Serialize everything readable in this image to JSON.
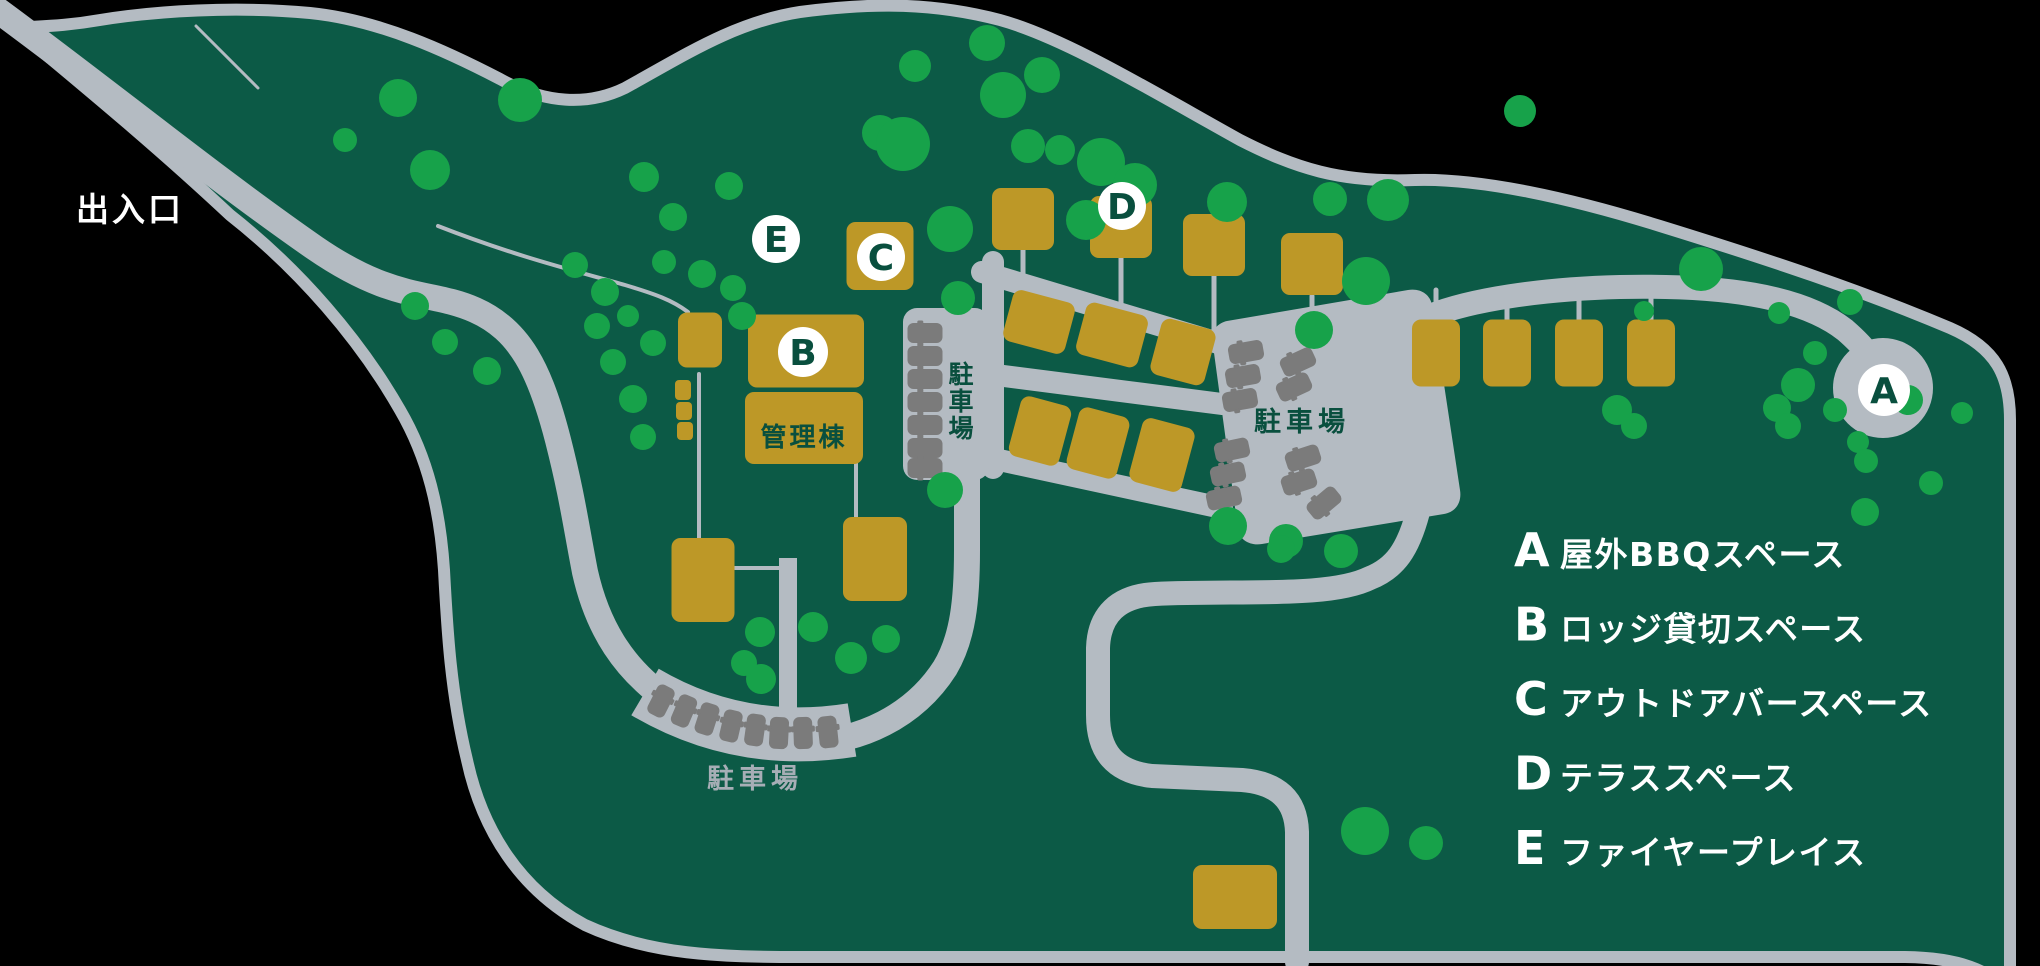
{
  "title": "キャンプ場 施設マップ",
  "colors": {
    "outside": "#000000",
    "ground": "#0c5a46",
    "road": "#b4bbc2",
    "tree": "#17a24a",
    "building": "#bd9827",
    "car": "#7b7b7b",
    "marker_bg": "#ffffff",
    "marker_letter": "#094f3e",
    "label_dark": "#094f3e",
    "label_gray": "#a7aeb6",
    "label_white": "#ffffff"
  },
  "labels": [
    {
      "name": "entrance-label",
      "text": "出入口",
      "x": 76,
      "y": 221,
      "size": 33,
      "color": "#ffffff",
      "anchor": "start",
      "spacing": 3
    },
    {
      "name": "admin-building-label",
      "text": "管理棟",
      "x": 804,
      "y": 446,
      "size": 26,
      "color": "#094f3e",
      "anchor": "middle",
      "spacing": 3
    },
    {
      "name": "parking-label-left",
      "text": "駐車場",
      "x": 961,
      "y": 383,
      "size": 25,
      "color": "#094f3e",
      "anchor": "middle",
      "vertical": true,
      "lineStep": 27
    },
    {
      "name": "parking-label-right",
      "text": "駐車場",
      "x": 1302,
      "y": 431,
      "size": 27,
      "color": "#094f3e",
      "anchor": "middle",
      "spacing": 5
    },
    {
      "name": "parking-label-bottom",
      "text": "駐車場",
      "x": 755,
      "y": 788,
      "size": 27,
      "color": "#a7aeb6",
      "anchor": "middle",
      "spacing": 5
    }
  ],
  "markers": [
    {
      "letter": "A",
      "x": 1884,
      "y": 390,
      "r": 26
    },
    {
      "letter": "B",
      "x": 803,
      "y": 352,
      "r": 25
    },
    {
      "letter": "C",
      "x": 881,
      "y": 257,
      "r": 24
    },
    {
      "letter": "D",
      "x": 1122,
      "y": 206,
      "r": 24
    },
    {
      "letter": "E",
      "x": 776,
      "y": 239,
      "r": 24
    }
  ],
  "legend": {
    "x_letter": 1514,
    "x_text": 1560,
    "y_start": 566,
    "y_step": 74.5,
    "items": [
      {
        "letter": "A",
        "text": "屋外BBQスペース"
      },
      {
        "letter": "B",
        "text": "ロッジ貸切スペース"
      },
      {
        "letter": "C",
        "text": "アウトドアバースペース"
      },
      {
        "letter": "D",
        "text": "テラススペース"
      },
      {
        "letter": "E",
        "text": "ファイヤープレイス"
      }
    ]
  },
  "map": {
    "trees": [
      [
        415,
        306,
        14
      ],
      [
        445,
        342,
        13
      ],
      [
        487,
        371,
        14
      ],
      [
        597,
        326,
        13
      ],
      [
        628,
        316,
        11
      ],
      [
        653,
        343,
        13
      ],
      [
        613,
        362,
        13
      ],
      [
        633,
        399,
        14
      ],
      [
        643,
        437,
        13
      ],
      [
        575,
        265,
        13
      ],
      [
        605,
        292,
        14
      ],
      [
        664,
        262,
        12
      ],
      [
        702,
        274,
        14
      ],
      [
        733,
        288,
        13
      ],
      [
        742,
        316,
        14
      ],
      [
        644,
        177,
        15
      ],
      [
        673,
        217,
        14
      ],
      [
        729,
        186,
        14
      ],
      [
        398,
        98,
        19
      ],
      [
        345,
        140,
        12
      ],
      [
        520,
        100,
        22
      ],
      [
        430,
        170,
        20
      ],
      [
        880,
        133,
        18
      ],
      [
        903,
        144,
        27
      ],
      [
        915,
        66,
        16
      ],
      [
        987,
        43,
        18
      ],
      [
        1003,
        95,
        23
      ],
      [
        1042,
        75,
        18
      ],
      [
        1028,
        146,
        17
      ],
      [
        1060,
        150,
        15
      ],
      [
        1101,
        162,
        24
      ],
      [
        1135,
        185,
        22
      ],
      [
        1086,
        220,
        20
      ],
      [
        950,
        229,
        23
      ],
      [
        958,
        298,
        17
      ],
      [
        1227,
        202,
        20
      ],
      [
        1330,
        199,
        17
      ],
      [
        1520,
        111,
        16
      ],
      [
        1314,
        330,
        19
      ],
      [
        1357,
        281,
        11
      ],
      [
        945,
        490,
        18
      ],
      [
        760,
        632,
        15
      ],
      [
        813,
        627,
        15
      ],
      [
        851,
        658,
        16
      ],
      [
        886,
        639,
        14
      ],
      [
        761,
        679,
        15
      ],
      [
        744,
        663,
        13
      ],
      [
        1228,
        526,
        19
      ],
      [
        1286,
        541,
        17
      ],
      [
        1281,
        549,
        14
      ],
      [
        1341,
        551,
        17
      ],
      [
        1365,
        831,
        24
      ],
      [
        1426,
        843,
        17
      ],
      [
        1388,
        200,
        21
      ],
      [
        1366,
        281,
        24
      ],
      [
        1701,
        269,
        22
      ],
      [
        1644,
        311,
        10
      ],
      [
        1617,
        410,
        15
      ],
      [
        1634,
        426,
        13
      ],
      [
        1779,
        313,
        11
      ],
      [
        1815,
        353,
        12
      ],
      [
        1798,
        385,
        17
      ],
      [
        1835,
        410,
        12
      ],
      [
        1777,
        408,
        14
      ],
      [
        1788,
        426,
        13
      ],
      [
        1858,
        442,
        11
      ],
      [
        1866,
        461,
        12
      ],
      [
        1908,
        400,
        15
      ],
      [
        1962,
        413,
        11
      ],
      [
        1931,
        483,
        12
      ],
      [
        1865,
        512,
        14
      ],
      [
        1850,
        302,
        13
      ]
    ],
    "buildings": [
      [
        700,
        340,
        44,
        55,
        0
      ],
      [
        683,
        390,
        16,
        20,
        0
      ],
      [
        684,
        411,
        16,
        18,
        0
      ],
      [
        685,
        431,
        16,
        18,
        0
      ],
      [
        806,
        351,
        116,
        73,
        0
      ],
      [
        804,
        428,
        118,
        72,
        0
      ],
      [
        880,
        256,
        67,
        68,
        0
      ],
      [
        1023,
        219,
        62,
        62,
        0
      ],
      [
        1121,
        227,
        62,
        62,
        0
      ],
      [
        1214,
        245,
        62,
        62,
        0
      ],
      [
        1312,
        264,
        62,
        62,
        0
      ],
      [
        1039,
        322,
        64,
        53,
        15
      ],
      [
        1112,
        335,
        64,
        54,
        15
      ],
      [
        1183,
        352,
        56,
        58,
        15
      ],
      [
        1040,
        431,
        52,
        62,
        15
      ],
      [
        1098,
        443,
        52,
        64,
        15
      ],
      [
        1162,
        455,
        54,
        66,
        15
      ],
      [
        703,
        580,
        63,
        84,
        0
      ],
      [
        875,
        559,
        64,
        84,
        0
      ],
      [
        1436,
        353,
        48,
        67,
        0
      ],
      [
        1507,
        353,
        48,
        67,
        0
      ],
      [
        1579,
        353,
        48,
        67,
        0
      ],
      [
        1651,
        353,
        48,
        67,
        0
      ],
      [
        1235,
        897,
        84,
        64,
        0
      ]
    ],
    "cars": {
      "strip": [
        [
          925,
          333,
          0
        ],
        [
          925,
          356,
          0
        ],
        [
          925,
          379,
          0
        ],
        [
          925,
          402,
          0
        ],
        [
          925,
          425,
          0
        ],
        [
          925,
          448,
          0
        ],
        [
          925,
          468,
          0
        ]
      ],
      "right_lot": [
        [
          1246,
          352,
          -10
        ],
        [
          1243,
          376,
          -10
        ],
        [
          1240,
          400,
          -10
        ],
        [
          1232,
          450,
          -12
        ],
        [
          1228,
          474,
          -12
        ],
        [
          1224,
          498,
          -12
        ],
        [
          1298,
          362,
          -25
        ],
        [
          1294,
          387,
          -25
        ],
        [
          1303,
          458,
          -18
        ],
        [
          1299,
          482,
          -18
        ],
        [
          1324,
          503,
          -40
        ]
      ],
      "arc": [
        [
          661,
          701,
          27
        ],
        [
          684,
          711,
          23
        ],
        [
          707,
          719,
          18
        ],
        [
          731,
          726,
          13
        ],
        [
          755,
          730,
          8
        ],
        [
          779,
          733,
          3
        ],
        [
          803,
          733,
          -2
        ],
        [
          828,
          732,
          -6
        ]
      ]
    }
  }
}
